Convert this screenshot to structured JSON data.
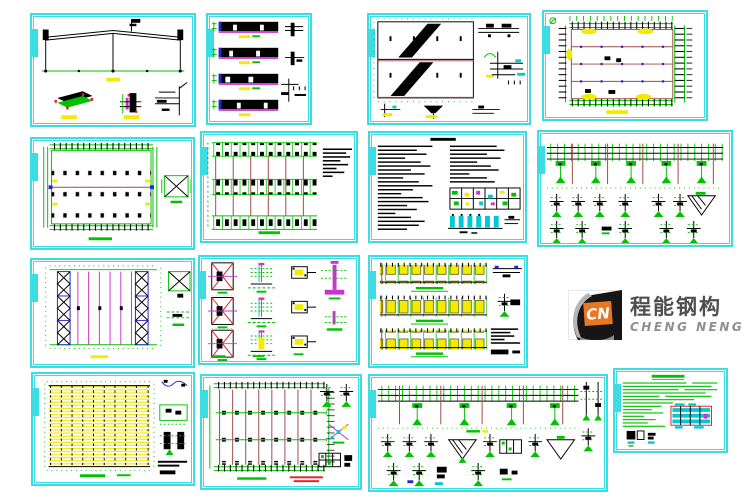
{
  "page": {
    "width": 750,
    "height": 500,
    "background": "#ffffff"
  },
  "palette": {
    "frame": "#3bdce2",
    "green": "#00c200",
    "yellow": "#f2ea00",
    "magenta": "#cc33cc",
    "blue": "#2626cc",
    "brick": "#a04848",
    "red": "#dd2222",
    "cyan": "#00c8d4"
  },
  "logo": {
    "abbr": "CN",
    "name_zh": "程能钢构",
    "name_en": "CHENG NENG",
    "orange": "#e87722",
    "dark": "#161616",
    "silver": "#b5b5b5",
    "zh_color": "#4f4f4f",
    "en_color": "#8f8f8f"
  },
  "sheets": [
    {
      "id": "sheet-1",
      "kind": "building-cross-section-with-details"
    },
    {
      "id": "sheet-2",
      "kind": "wall-elevation-strips"
    },
    {
      "id": "sheet-3",
      "kind": "gable-elevations-with-stairs"
    },
    {
      "id": "sheet-4",
      "kind": "roof-framing-plan"
    },
    {
      "id": "sheet-5",
      "kind": "column-layout-plan-with-brace-detail"
    },
    {
      "id": "sheet-6",
      "kind": "foundation-plan-with-notes"
    },
    {
      "id": "sheet-7",
      "kind": "general-notes-and-schedule"
    },
    {
      "id": "sheet-8",
      "kind": "crane-beam-elevation-and-details"
    },
    {
      "id": "sheet-9",
      "kind": "roof-bracing-plan"
    },
    {
      "id": "sheet-10",
      "kind": "column-base-details"
    },
    {
      "id": "sheet-11",
      "kind": "truss-elevations"
    },
    {
      "id": "sheet-12",
      "kind": "purlin-layout-plan"
    },
    {
      "id": "sheet-13",
      "kind": "bracing-layout-plan-with-details"
    },
    {
      "id": "sheet-14",
      "kind": "frame-elevation-and-joint-details"
    },
    {
      "id": "sheet-15",
      "kind": "green-notes-with-table"
    }
  ]
}
